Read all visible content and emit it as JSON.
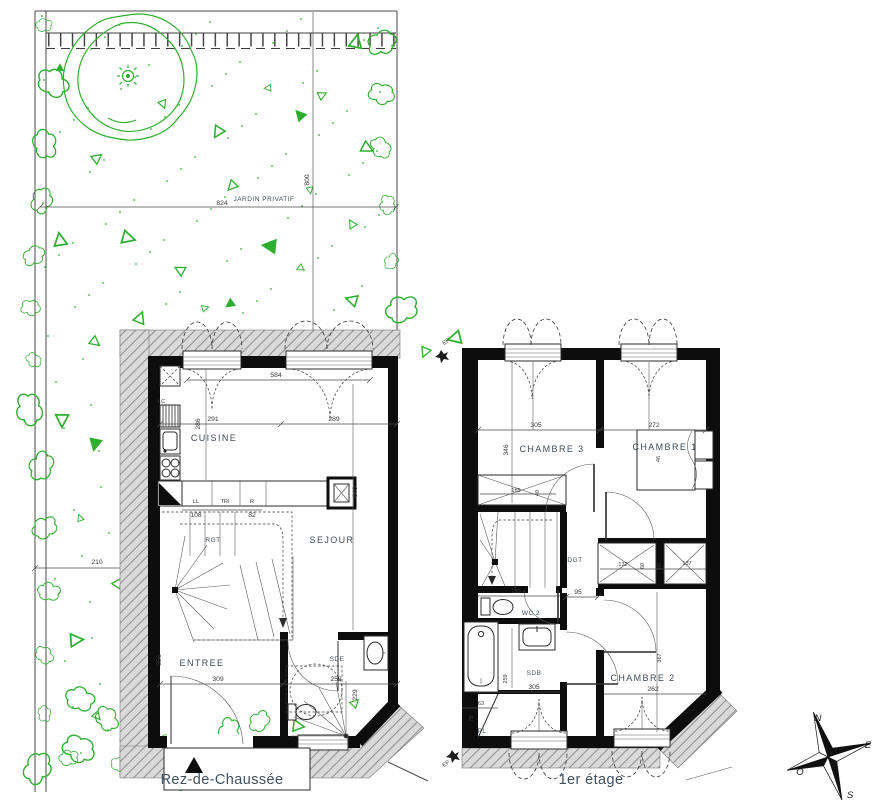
{
  "titles": {
    "ground": "Rez-de-Chaussée",
    "first": "1er étage"
  },
  "garden": {
    "label": "JARDIN PRIVATIF",
    "dim_width": "824",
    "dim_depth": "800",
    "dim_side": "210"
  },
  "ground": {
    "rooms": {
      "cuisine": "CUISINE",
      "sejour": "SEJOUR",
      "entree": "ENTREE",
      "sde": "SDE",
      "rgt": "RGT"
    },
    "appliances": {
      "lc": "LC",
      "ll": "LL",
      "tri": "TRI",
      "r": "R"
    },
    "dims": {
      "window_span": "584",
      "cuisine_w": "291",
      "sejour_w": "289",
      "cuisine_h": "286",
      "sejour_h": "649",
      "counter_left": "108",
      "counter_right": "82",
      "entree_w": "309",
      "entree_h": "356",
      "sde_w": "258",
      "sde_h": "229"
    }
  },
  "first": {
    "rooms": {
      "chambre3": "CHAMBRE 3",
      "chambre1": "CHAMBRE 1",
      "chambre2": "CHAMBRE 2",
      "dgt": "DGT",
      "wc": "WC 2",
      "sdb": "SDB",
      "pl": "PL"
    },
    "dims": {
      "chambre3_w": "305",
      "chambre3_h": "346",
      "chambre1_w": "272",
      "chambre1_h": "46",
      "closet_w": "185",
      "closet_d": "40",
      "stair_w": "180",
      "hall_w": "95",
      "storage1": "132",
      "storage2": "60",
      "storage3": "60",
      "storage4": "137",
      "sdb_w": "305",
      "sdb_h": "259",
      "chambre2_w": "262",
      "chambre2_h": "367",
      "pl_w": "63",
      "pl_d": "78"
    },
    "downspout": "EP"
  },
  "compass": {
    "n": "N",
    "e": "E",
    "s": "S",
    "o": "O"
  },
  "colors": {
    "green": "#2fae2f",
    "hatch_bg": "#d9d9d9",
    "hatch_line": "#8d8d8d",
    "wall": "#0d0d0d",
    "label": "#3e4b58"
  }
}
